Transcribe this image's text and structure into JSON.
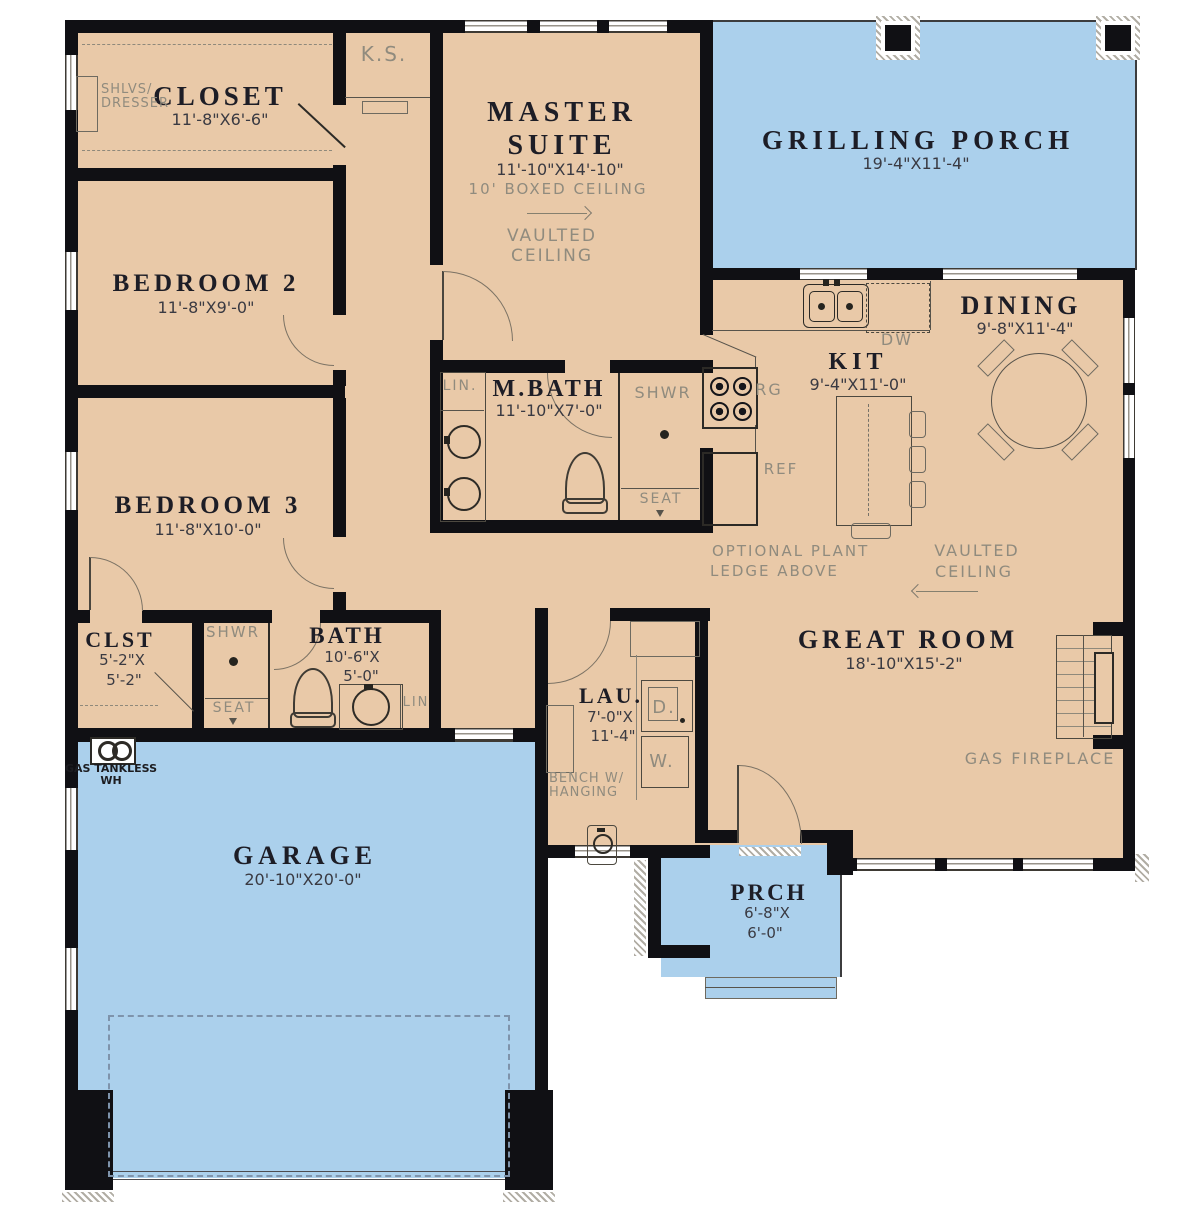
{
  "colors": {
    "room_fill": "#e9c9a8",
    "outdoor_fill": "#abd0ec",
    "wall": "#101014",
    "room_name_text": "#1d1d26",
    "dimension_text": "#3a3a42",
    "note_text": "#908b7e"
  },
  "rooms": {
    "closet": {
      "name": "CLOSET",
      "dims": "11'-8\"X6'-6\"",
      "shelves_line1": "SHLVS/",
      "shelves_line2": "DRESSER"
    },
    "ks_nook": {
      "label": "K.S."
    },
    "master_suite": {
      "name_line1": "MASTER",
      "name_line2": "SUITE",
      "dims": "11'-10\"X14'-10\"",
      "ceiling_note": "10' BOXED CEILING",
      "vaulted_line1": "VAULTED",
      "vaulted_line2": "CEILING"
    },
    "grilling_porch": {
      "name": "GRILLING PORCH",
      "dims": "19'-4\"X11'-4\""
    },
    "bedroom2": {
      "name": "BEDROOM 2",
      "dims": "11'-8\"X9'-0\""
    },
    "bedroom3": {
      "name": "BEDROOM 3",
      "dims": "11'-8\"X10'-0\""
    },
    "master_bath": {
      "name": "M.BATH",
      "dims": "11'-10\"X7'-0\"",
      "linen": "LIN.",
      "shower": "SHWR",
      "seat": "SEAT"
    },
    "kitchen": {
      "name": "KIT",
      "dims": "9'-4\"X11'-0\"",
      "dishwasher": "DW",
      "range": "RG",
      "refrigerator": "REF"
    },
    "dining": {
      "name": "DINING",
      "dims": "9'-8\"X11'-4\""
    },
    "great_room": {
      "name": "GREAT ROOM",
      "dims": "18'-10\"X15'-2\"",
      "plant_ledge_line1": "OPTIONAL PLANT",
      "plant_ledge_line2": "LEDGE ABOVE",
      "vaulted_line1": "VAULTED",
      "vaulted_line2": "CEILING",
      "fireplace": "GAS FIREPLACE"
    },
    "closet2": {
      "name": "CLST",
      "dims_line1": "5'-2\"X",
      "dims_line2": "5'-2\""
    },
    "bath": {
      "name": "BATH",
      "dims_line1": "10'-6\"X",
      "dims_line2": "5'-0\"",
      "shower": "SHWR",
      "seat": "SEAT",
      "linen": "LIN"
    },
    "laundry": {
      "name": "LAU.",
      "dims_line1": "7'-0\"X",
      "dims_line2": "11'-4\"",
      "bench_line1": "BENCH W/",
      "bench_line2": "HANGING",
      "dryer": "D.",
      "washer": "W."
    },
    "garage": {
      "name": "GARAGE",
      "dims": "20'-10\"X20'-0\"",
      "water_heater_line1": "GAS TANKLESS",
      "water_heater_line2": "WH"
    },
    "porch": {
      "name": "PRCH",
      "dims_line1": "6'-8\"X",
      "dims_line2": "6'-0\""
    }
  }
}
